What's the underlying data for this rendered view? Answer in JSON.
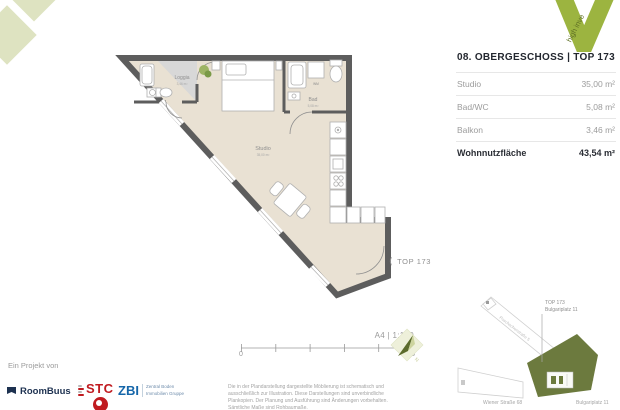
{
  "brand": {
    "v_logo_text": "high inve",
    "project_label": "Ein Projekt von",
    "logos": {
      "roombuus": "RoomBuus",
      "stc": "STC",
      "zbi": "ZBI",
      "zbi_sub1": "Zentral Boden",
      "zbi_sub2": "Immobilien Gruppe"
    }
  },
  "unit_panel": {
    "title": "08. OBERGESCHOSS | TOP 173",
    "rows": [
      {
        "label": "Studio",
        "value": "35,00 m²"
      },
      {
        "label": "Bad/WC",
        "value": "5,08 m²"
      },
      {
        "label": "Balkon",
        "value": "3,46 m²"
      }
    ],
    "total": {
      "label": "Wohnnutzfläche",
      "value": "43,54 m²"
    }
  },
  "plan": {
    "rooms": {
      "loggia": {
        "name": "Loggia",
        "area": "3,46 m²"
      },
      "studio": {
        "name": "Studio",
        "area": "35,00 m²"
      },
      "bad": {
        "name": "Bad",
        "area": "5,08 m²"
      }
    },
    "wm_label": "WM",
    "callout": "TOP 173"
  },
  "scalebar": {
    "format": "A4 | 1:100",
    "start": "0",
    "end": "5"
  },
  "north": {
    "letter": "N"
  },
  "sitemap": {
    "callout_top": "TOP 173",
    "callout_address": "Bulgariplatz 11",
    "street_diagonal": "Poschacherstraße 5",
    "street_left": "Wiener Straße 68",
    "street_right": "Bulgariplatz 11"
  },
  "footer": {
    "disclaimer": "Die in der Plandarstellung dargestellte Möblierung ist schematisch und ausschließlich zur Illustration. Diese Darstellungen sind unverbindliche Plankopien. Der Planung und Ausführung sind Änderungen vorbehalten. Sämtliche Maße sind Rohbaumaße."
  },
  "icons": {
    "chevron_left": "⟨"
  },
  "colors": {
    "accent_green": "#9cb440",
    "pale_green": "#dee3c1",
    "olive": "#6c7a3e",
    "wall": "#5d5d5d",
    "floor": "#e9e1d3",
    "navy": "#1d3150",
    "red": "#c01b20",
    "blue": "#1566a9"
  }
}
